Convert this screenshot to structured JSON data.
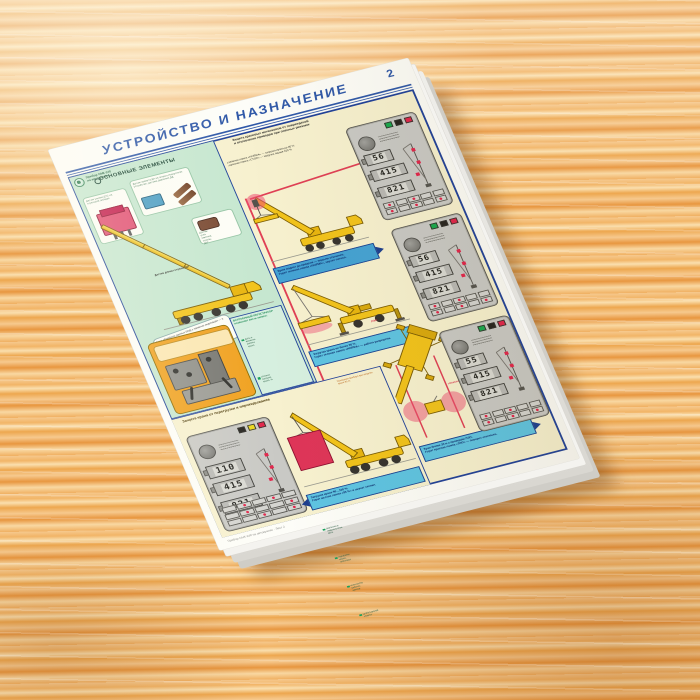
{
  "page_number": "2",
  "header": {
    "title": "УСТРОЙСТВО  И  НАЗНАЧЕНИЕ"
  },
  "brand": {
    "line1": "Прибор ОНК-140",
    "line2": "на автокранах"
  },
  "elements": {
    "heading": "ОСНОВНЫЕ  ЭЛЕМЕНТЫ",
    "force_label": "Датчик усилия ДУС на стреловой лебедке",
    "azimuth_label": "Датчик азимута ДА на опорно-поворотном устройстве, датчики давления ДД",
    "angle_label": "Датчик угла наклона стрелы ДУГ",
    "length_label": "Датчик длины стрелы ДЛ",
    "callout": "Блок обработки данных БОД с панелью индикации — в кабине крановщика",
    "recorder": {
      "heading": "ВСТРОЕННЫЙ РЕГИСТРАТОР",
      "subheading": "позволяет вести запись:",
      "items": [
        "даты и времени работы крана",
        "степени загрузки крана, %",
        "массы поднимаемого груза, т",
        "вылета и длины стрелы, м",
        "угла наклона стрелы, град",
        "высоты подъема крюка, м",
        "давления в гидросистеме, МПа",
        "наработки крана, моточасы",
        "количества рабочих циклов",
        "срабатываний защиты"
      ]
    }
  },
  "protection": {
    "heading_line1": "Защита крановых механизмов от повреждений",
    "heading_line2": "и отключение приводов при опасных режимах",
    "note1": "зеленая лампа «НОРМА» — загрузка крана до 90 %",
    "note2": "красная лампа «СТОП» — загрузка свыше 100 %"
  },
  "overload": {
    "heading": "Защита крана от перегрузки и опрокидывания",
    "note": "Показания прибора при загрузке крана 90 %"
  },
  "scenarios": [
    {
      "line1": "Крюк поднят до предела — подъем отключен.",
      "line2": "Горит зеленая лампа «НОРМА», звучит сигнал."
    },
    {
      "line1": "Загрузка крана не более 90 %.",
      "line2": "Горит зеленая лампа «НОРМА» — работа разрешена."
    },
    {
      "line1": "Загрузка крана 90…100 %.",
      "line2": "Горит желтая лампа «95 %» и звучит сигнал."
    },
    {
      "line1": "Кран ближе 30 м к проводам ЛЭП.",
      "line2": "Горит красная лампа «ЛЭП» — поворот отключен."
    }
  ],
  "danger": {
    "zone_label": "«ОПАСНАЯ ЗОНА»",
    "wire_label": "ЛЭП"
  },
  "panels": [
    {
      "name": "control-panel-1",
      "displays": [
        "56",
        "415",
        "821"
      ],
      "indicators": [
        "#18a94e",
        "#26241f",
        "#e1254b"
      ]
    },
    {
      "name": "control-panel-2",
      "displays": [
        "56",
        "415",
        "821"
      ],
      "indicators": [
        "#18a94e",
        "#26241f",
        "#e1254b"
      ]
    },
    {
      "name": "control-panel-3",
      "displays": [
        "55",
        "415",
        "821"
      ],
      "indicators": [
        "#18a94e",
        "#26241f",
        "#e1254b"
      ]
    },
    {
      "name": "control-panel-4",
      "displays": [
        "110",
        "415",
        "821"
      ],
      "indicators": [
        "#26241f",
        "#ead71c",
        "#e1254b"
      ]
    }
  ],
  "footer": {
    "imprint": "Прибор ОНК-140 на автокранах · Лист 2"
  },
  "colors": {
    "accent_blue": "#2f58a8",
    "frame_blue": "#20419a",
    "cream": "#f7f1cf",
    "mint": "#c6e7d0",
    "caption_cyan": "#5ec4e2",
    "crane_yellow": "#f2c31b",
    "danger_red": "#e1254b"
  }
}
